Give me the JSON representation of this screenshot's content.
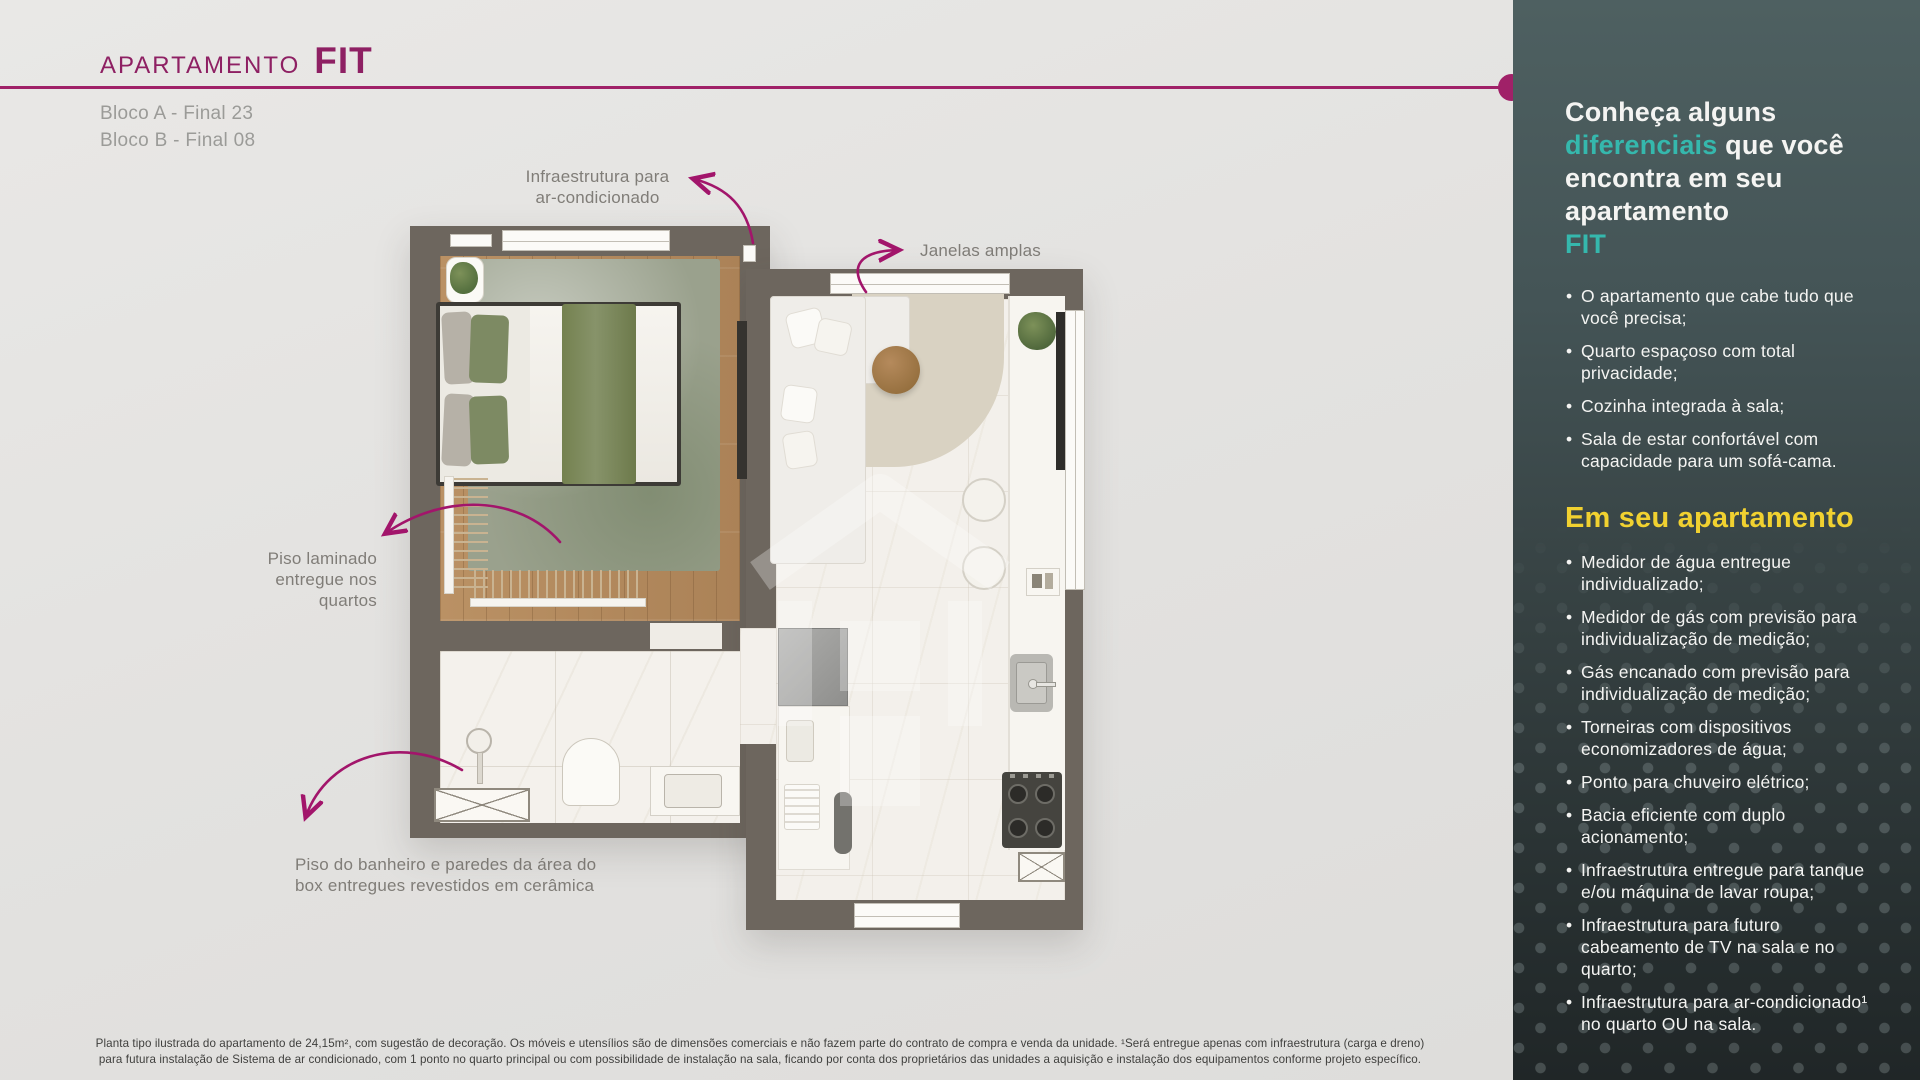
{
  "header": {
    "title_small": "APARTAMENTO",
    "title_big": "FIT",
    "block_line1": "Bloco A - Final 23",
    "block_line2": "Bloco B - Final 08"
  },
  "annotations": {
    "ac": "Infraestrutura para\nar-condicionado",
    "windows": "Janelas amplas",
    "laminate": "Piso laminado\nentregue nos\nquartos",
    "bathroom": "Piso do banheiro e paredes da área do\nbox entregues revestidos em cerâmica"
  },
  "sidebar": {
    "heading": {
      "p1": "Conheça alguns ",
      "accent1": "diferenciais",
      "p2": " que você encontra em seu apartamento",
      "accent2": "FIT"
    },
    "diferenciais": [
      "O apartamento que cabe tudo que você precisa;",
      "Quarto espaçoso com total privacidade;",
      "Cozinha integrada à sala;",
      "Sala de estar confortável com capacidade para um sofá-cama."
    ],
    "section2_title": "Em seu apartamento",
    "em_seu_apartamento": [
      "Medidor de água entregue individualizado;",
      "Medidor de gás com previsão para individualização de medição;",
      "Gás encanado com previsão para individualização de medição;",
      "Torneiras com dispositivos economizadores de água;",
      "Ponto para chuveiro elétrico;",
      "Bacia eficiente com duplo acionamento;",
      "Infraestrutura entregue para tanque e/ou máquina de lavar roupa;",
      "Infraestrutura para futuro cabeamento de TV na sala e no quarto;",
      "Infraestrutura para ar-condicionado¹ no quarto OU na sala."
    ]
  },
  "disclaimer": {
    "line1": "Planta tipo ilustrada do apartamento de 24,15m², com sugestão de decoração. Os móveis e utensílios são de dimensões comerciais e não fazem parte do contrato de compra e venda da unidade.  ¹Será entregue apenas com infraestrutura (carga e dreno)",
    "line2": "para futura instalação de Sistema de ar condicionado, com 1 ponto no quarto principal ou com possibilidade de instalação na sala, ficando por conta dos proprietários das unidades a aquisição e instalação dos equipamentos conforme projeto específico."
  },
  "colors": {
    "accent_magenta": "#9E1F63",
    "accent_teal": "#35B8AD",
    "accent_yellow": "#F1D130",
    "wall": "#6D665E",
    "sidebar_top": "#4E6061",
    "sidebar_bottom": "#202627"
  }
}
